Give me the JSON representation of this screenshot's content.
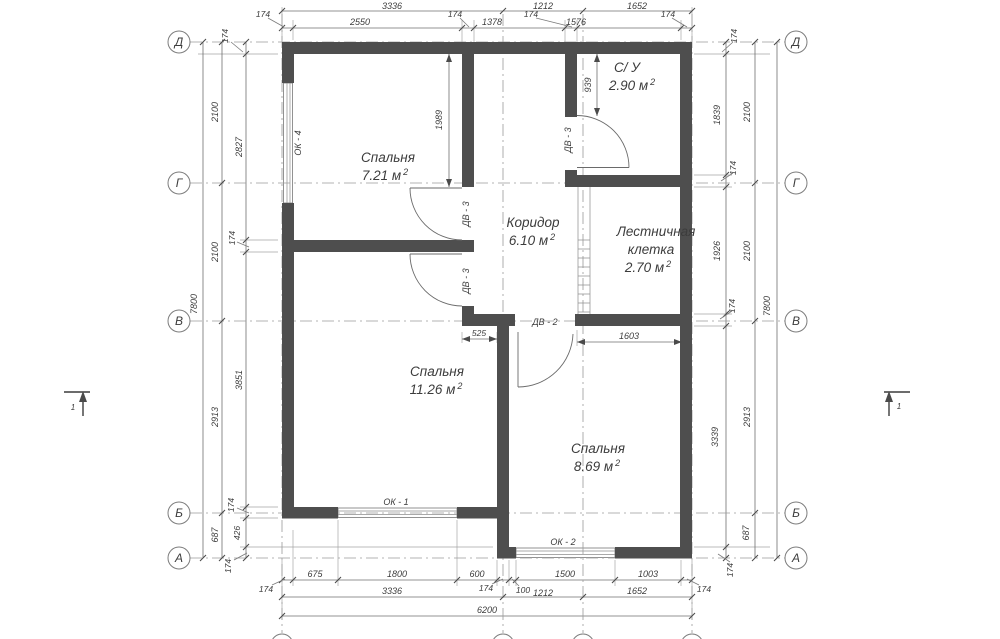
{
  "plan": {
    "rooms": {
      "bedroom1": {
        "name": "Спальня",
        "area": "7.21 м",
        "sup": "2"
      },
      "bathroom": {
        "name": "С/ У",
        "area": "2.90 м",
        "sup": "2"
      },
      "corridor": {
        "name": "Коридор",
        "area": "6.10 м",
        "sup": "2"
      },
      "stairwell": {
        "line1": "Лестничная",
        "line2": "клетка",
        "area": "2.70 м",
        "sup": "2"
      },
      "bedroom2": {
        "name": "Спальня",
        "area": "11.26 м",
        "sup": "2"
      },
      "bedroom3": {
        "name": "Спальня",
        "area": "8.69 м",
        "sup": "2"
      }
    },
    "openings": {
      "ok1": "ОК - 1",
      "ok2": "ОК - 2",
      "ok4": "ОК - 4",
      "dv2": "ДВ - 2",
      "dv3": "ДВ - 3"
    },
    "axes": {
      "row": [
        "Д",
        "Г",
        "В",
        "Б",
        "А"
      ],
      "col": [
        "1",
        "2",
        "3",
        "4"
      ]
    },
    "section_mark": "1",
    "dims": {
      "d3336": "3336",
      "d1212": "1212",
      "d1652": "1652",
      "d2550": "2550",
      "d1378": "1378",
      "d1576": "1576",
      "d174": "174",
      "d100": "100",
      "d675": "675",
      "d1800": "1800",
      "d600": "600",
      "d1500": "1500",
      "d1003": "1003",
      "d6200": "6200",
      "d7800": "7800",
      "d2100": "2100",
      "d2913": "2913",
      "d687": "687",
      "d2827": "2827",
      "d3851": "3851",
      "d426": "426",
      "d1839": "1839",
      "d1926": "1926",
      "d3339": "3339",
      "d1989": "1989",
      "d939": "939",
      "d525": "525",
      "d1603": "1603"
    }
  }
}
